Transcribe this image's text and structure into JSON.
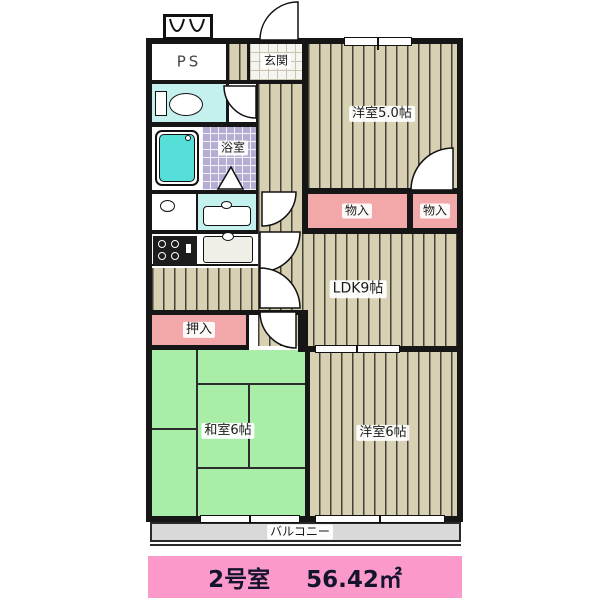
{
  "title": {
    "room_no": "2号室",
    "area": "56.42㎡"
  },
  "rooms": {
    "ps": {
      "label": "PS"
    },
    "genkan": {
      "label": "玄関"
    },
    "bathroom": {
      "label": "浴室"
    },
    "western5": {
      "label": "洋室5.0帖"
    },
    "storage1": {
      "label": "物入"
    },
    "storage2": {
      "label": "物入"
    },
    "ldk": {
      "label": "LDK9帖"
    },
    "oshiire": {
      "label": "押入"
    },
    "japanese6": {
      "label": "和室6帖"
    },
    "western6": {
      "label": "洋室6帖"
    },
    "balcony": {
      "label": "バルコニー"
    }
  },
  "colors": {
    "wood_floor": "#d7d0b2",
    "tatami_green": "#a8eea8",
    "closet_pink": "#f2a8a8",
    "water_cyan": "#c4f0ee",
    "bathtub_cyan": "#55dfd8",
    "bath_tile_purple": "#b5add2",
    "balcony_gray": "#d9d9d9",
    "banner_pink": "#fb9aca",
    "wall_black": "#161616"
  }
}
